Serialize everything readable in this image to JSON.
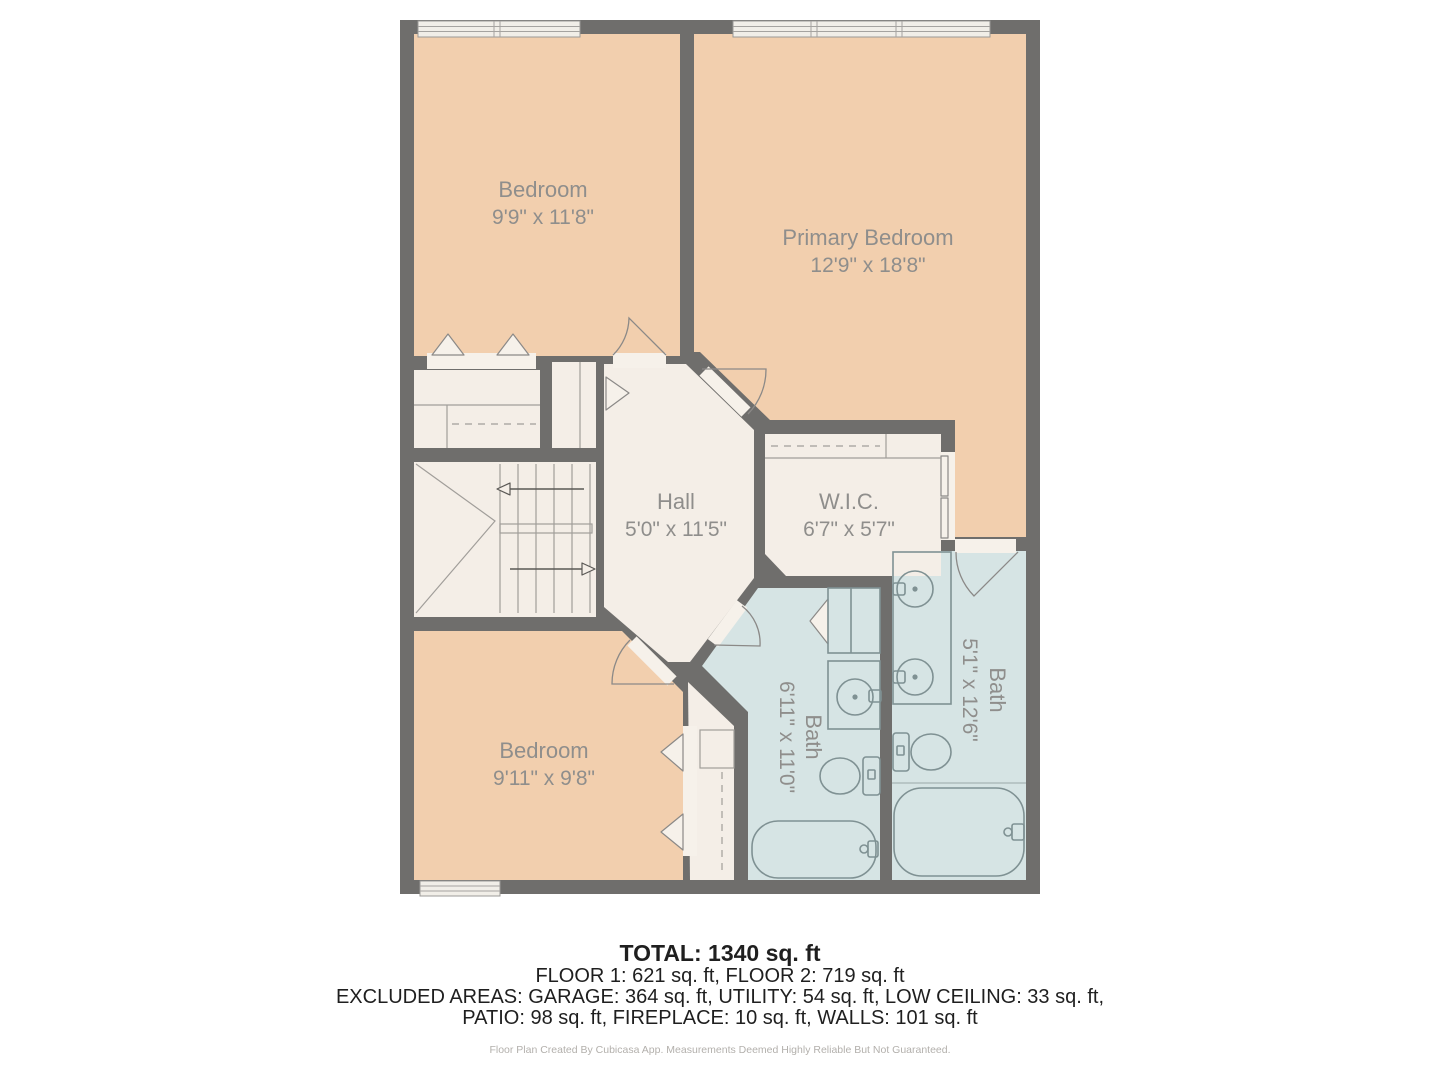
{
  "plan": {
    "rooms": [
      {
        "id": "bedroom-top",
        "name": "Bedroom",
        "dims": "9'9\" x 11'8\""
      },
      {
        "id": "primary-bedroom",
        "name": "Primary Bedroom",
        "dims": "12'9\" x 18'8\""
      },
      {
        "id": "hall",
        "name": "Hall",
        "dims": "5'0\" x 11'5\""
      },
      {
        "id": "wic",
        "name": "W.I.C.",
        "dims": "6'7\" x 5'7\""
      },
      {
        "id": "bedroom-bottom",
        "name": "Bedroom",
        "dims": "9'11\" x 9'8\""
      },
      {
        "id": "bath-small",
        "name": "Bath",
        "dims": "6'11\" x 11'0\""
      },
      {
        "id": "bath-large",
        "name": "Bath",
        "dims": "5'1\" x 12'6\""
      }
    ],
    "colors": {
      "wall": "#6f6e6c",
      "bed": "#f2cfae",
      "common": "#f4eee7",
      "bath": "#d6e4e4",
      "line": "#8b8987",
      "bline": "#7f9193",
      "label": "#8f8e8c",
      "sym": "#f6f1ea",
      "window": "#f1eee8",
      "arrow": "#5a5855"
    }
  },
  "footer": {
    "total": "TOTAL: 1340 sq. ft",
    "floors": "FLOOR 1: 621 sq. ft, FLOOR 2: 719 sq. ft",
    "excluded_line1": "EXCLUDED AREAS: GARAGE: 364 sq. ft, UTILITY: 54 sq. ft, LOW CEILING: 33 sq. ft,",
    "excluded_line2": "PATIO: 98 sq. ft, FIREPLACE: 10 sq. ft, WALLS: 101 sq. ft",
    "disclaimer": "Floor Plan Created By Cubicasa App. Measurements Deemed Highly Reliable But Not Guaranteed."
  }
}
